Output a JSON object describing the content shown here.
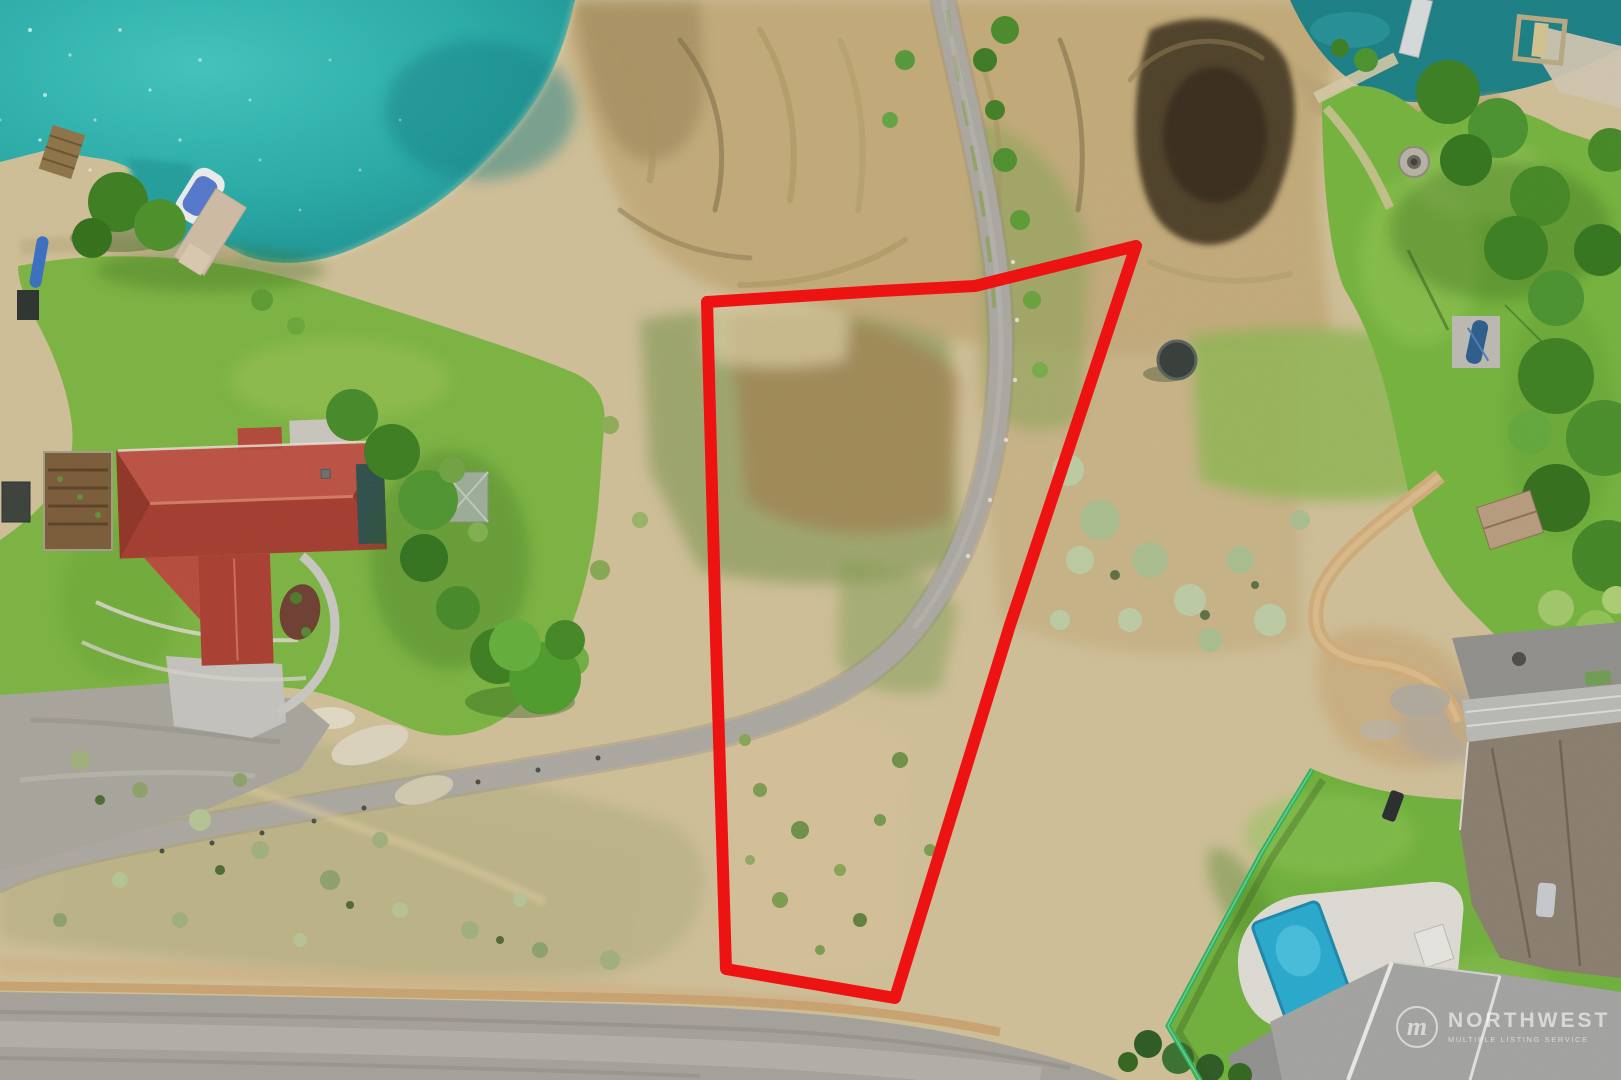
{
  "watermark": {
    "brand": "NORTHWEST",
    "tagline": "MULTIPLE LISTING SERVICE",
    "logo_letter": "m"
  },
  "boundary": {
    "points": "707,302 880,291 975,286 1136,246 1010,625 895,998 726,969 716,640",
    "color": "#ee1313",
    "stroke_width": "12"
  },
  "palette": {
    "boundary_red": "#ee1313",
    "lake_teal": "#2aa9a5",
    "pool_blue": "#2aa7c9",
    "fence_green": "#2fae5f",
    "roof_red": "#b04a3b",
    "watermark_white": "rgba(255,255,255,0.58)"
  }
}
